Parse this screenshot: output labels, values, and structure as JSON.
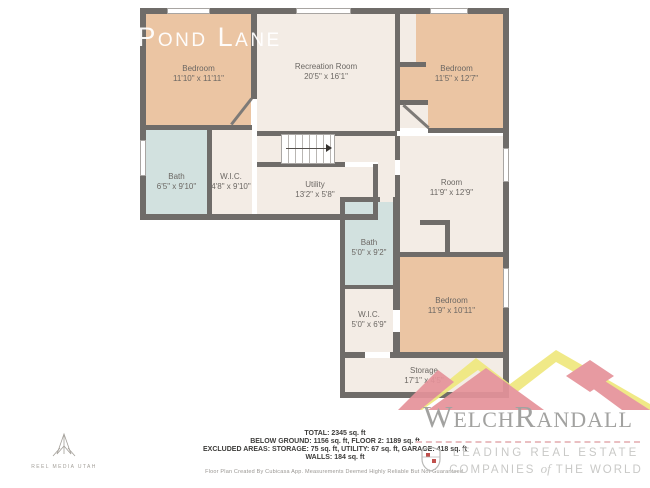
{
  "title": "ck Pond Lane",
  "colors": {
    "wall": "#6f6c69",
    "bedroom_fill": "#ebc5a3",
    "bath_fill": "#d2e1df",
    "floor_fill": "#f3ece5",
    "logo_pink": "#e5929a",
    "logo_yellow": "#efe87d"
  },
  "rooms": {
    "bedroom_tl": {
      "name": "Bedroom",
      "dims": "11'10\" x 11'11\""
    },
    "recreation": {
      "name": "Recreation Room",
      "dims": "20'5\" x 16'1\""
    },
    "bedroom_tr": {
      "name": "Bedroom",
      "dims": "11'5\" x 12'7\""
    },
    "bath_left": {
      "name": "Bath",
      "dims": "6'5\" x 9'10\""
    },
    "wic_left": {
      "name": "W.I.C.",
      "dims": "4'8\" x 9'10\""
    },
    "utility": {
      "name": "Utility",
      "dims": "13'2\" x 5'8\""
    },
    "room_right": {
      "name": "Room",
      "dims": "11'9\" x 12'9\""
    },
    "bath_mid": {
      "name": "Bath",
      "dims": "5'0\" x 9'2\""
    },
    "wic_mid": {
      "name": "W.I.C.",
      "dims": "5'0\" x 6'9\""
    },
    "bedroom_bottom": {
      "name": "Bedroom",
      "dims": "11'9\" x 10'11\""
    },
    "storage": {
      "name": "Storage",
      "dims": "17'1\" x 4'5\""
    }
  },
  "summary": {
    "total": "TOTAL: 2345 sq. ft",
    "floors": "BELOW GROUND: 1156 sq. ft, FLOOR 2: 1189 sq. ft",
    "excluded": "EXCLUDED AREAS: STORAGE: 75 sq. ft, UTILITY: 67 sq. ft, GARAGE: 418 sq. ft",
    "walls": "WALLS: 184 sq. ft",
    "disclaimer": "Floor Plan Created By Cubicasa App. Measurements Deemed Highly Reliable But Not Guaranteed."
  },
  "branding": {
    "reel_media": "REEL MEDIA UTAH",
    "welch_first": "Welch",
    "welch_second": "Randall",
    "tagline_line1": "LEADING REAL ESTATE",
    "tagline_line2_pre": "COMPANIES",
    "tagline_of": "of",
    "tagline_line2_post": "THE WORLD"
  }
}
